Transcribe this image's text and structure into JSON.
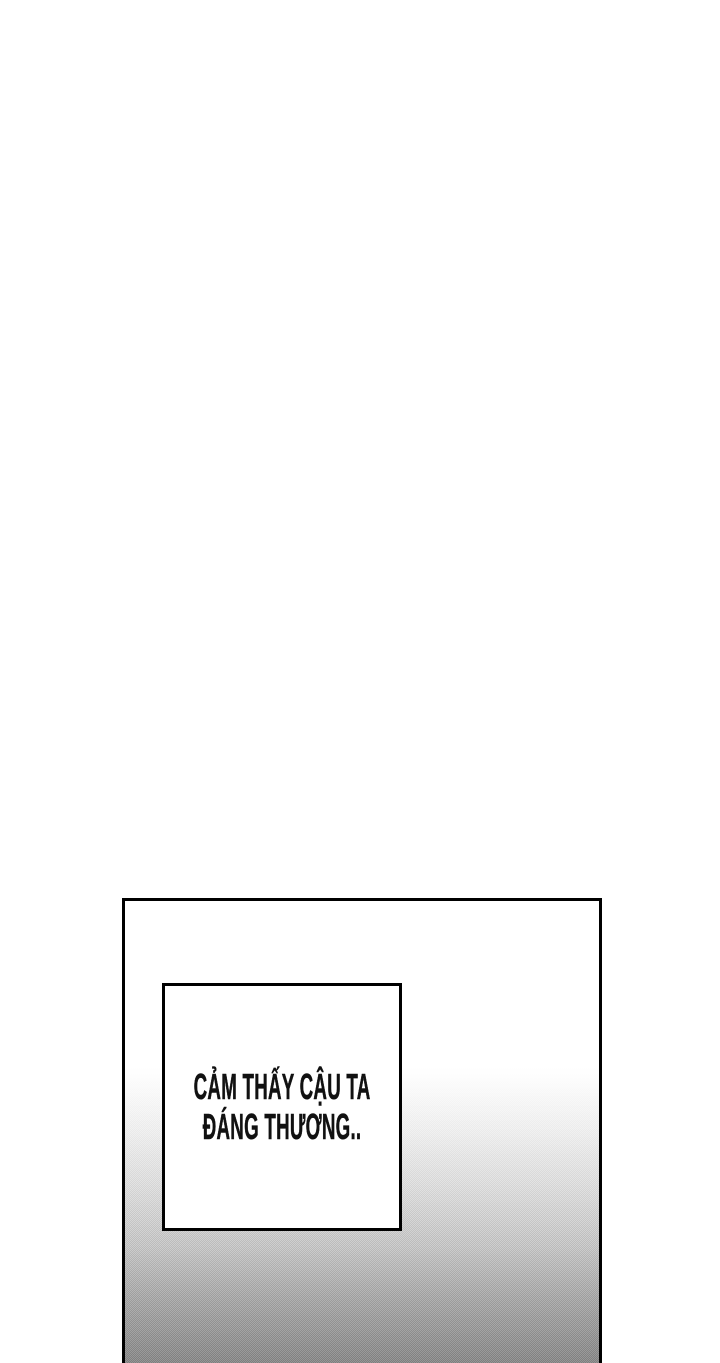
{
  "caption": {
    "lines": [
      "CẢM THẤY CẬU TA",
      "ĐÁNG THƯƠNG.."
    ]
  },
  "panel": {
    "border_color": "#000000",
    "gradient_top": "#ffffff",
    "gradient_bottom": "#8d8d8d",
    "texture": "halftone-dither"
  },
  "caption_style": {
    "text_color": "#111111",
    "box_background": "#ffffff",
    "box_border_color": "#000000"
  }
}
